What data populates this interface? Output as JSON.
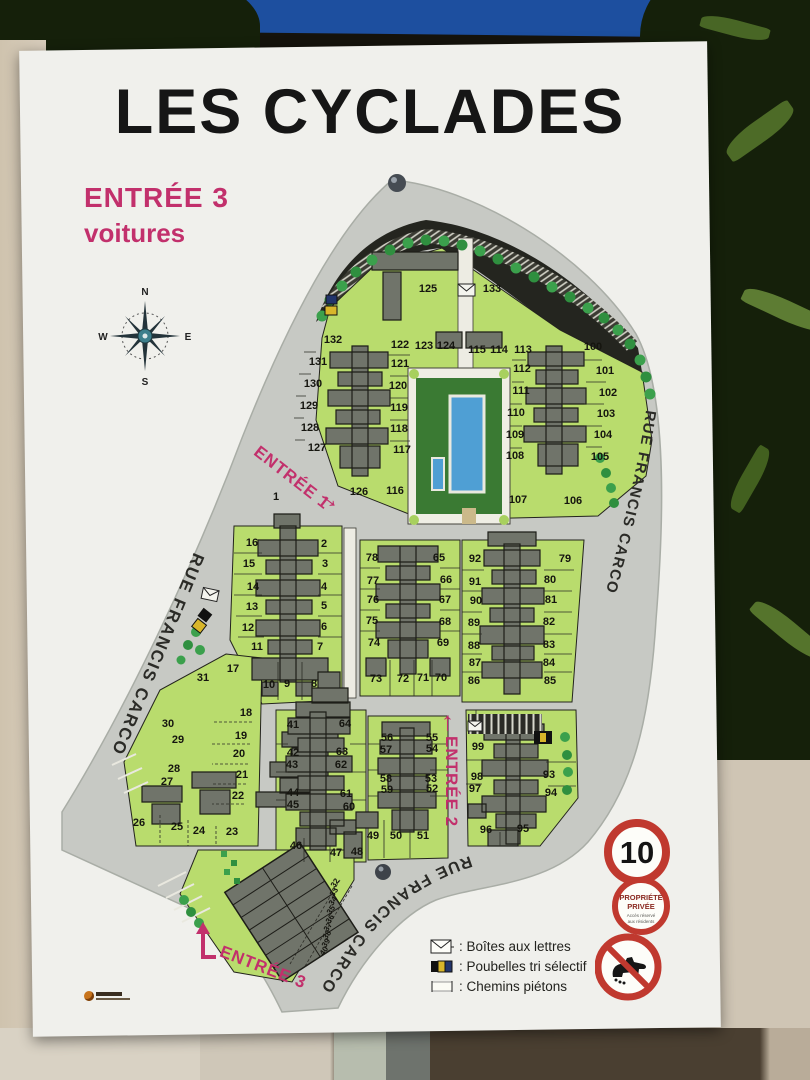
{
  "sign": {
    "title": "LES CYCLADES",
    "subtitle_line1": "ENTRÉE 3",
    "subtitle_line2": "voitures",
    "compass": {
      "n": "N",
      "e": "E",
      "s": "S",
      "w": "W"
    },
    "streets": {
      "left": "RUE FRANCIS CARCO",
      "right": "RUE FRANCIS CARCO",
      "bottom": "RUE FRANCIS CARCO"
    },
    "entrances": {
      "e1": {
        "label": "ENTRÉE 1",
        "arrow": "→"
      },
      "e2": {
        "label": "ENTRÉE 2",
        "arrow": "↑"
      },
      "e3": {
        "label": "ENTRÉE 3"
      }
    },
    "legend": {
      "items": [
        {
          "icon": "mailbox-icon",
          "label": ": Boîtes aux lettres"
        },
        {
          "icon": "recycle-bins-icon",
          "label": ": Poubelles tri sélectif"
        },
        {
          "icon": "footpath-icon",
          "label": ": Chemins piétons"
        }
      ]
    },
    "signs": {
      "speed_limit": "10",
      "private_line1": "PROPRIÉTÉ",
      "private_line2": "PRIVÉE",
      "private_sub1": "Accès réservé",
      "private_sub2": "aux résidents"
    },
    "colors": {
      "accent_pink": "#c2306c",
      "map_green": "#b9dc6d",
      "road_gray": "#c7c9c4",
      "building_gray": "#70746a",
      "pool_blue": "#4f9fd4",
      "sign_red": "#c0392f"
    },
    "plots": [
      {
        "n": "125",
        "x": 428,
        "y": 289
      },
      {
        "n": "133",
        "x": 492,
        "y": 289
      },
      {
        "n": "132",
        "x": 333,
        "y": 340
      },
      {
        "n": "131",
        "x": 318,
        "y": 362
      },
      {
        "n": "130",
        "x": 313,
        "y": 384
      },
      {
        "n": "129",
        "x": 309,
        "y": 406
      },
      {
        "n": "128",
        "x": 310,
        "y": 428
      },
      {
        "n": "127",
        "x": 317,
        "y": 448
      },
      {
        "n": "126",
        "x": 359,
        "y": 492
      },
      {
        "n": "116",
        "x": 395,
        "y": 491
      },
      {
        "n": "122",
        "x": 400,
        "y": 345
      },
      {
        "n": "121",
        "x": 400,
        "y": 364
      },
      {
        "n": "120",
        "x": 398,
        "y": 386
      },
      {
        "n": "119",
        "x": 399,
        "y": 408
      },
      {
        "n": "118",
        "x": 399,
        "y": 429
      },
      {
        "n": "117",
        "x": 402,
        "y": 450
      },
      {
        "n": "123",
        "x": 424,
        "y": 346
      },
      {
        "n": "124",
        "x": 446,
        "y": 346
      },
      {
        "n": "115",
        "x": 477,
        "y": 350
      },
      {
        "n": "114",
        "x": 499,
        "y": 350
      },
      {
        "n": "113",
        "x": 523,
        "y": 350
      },
      {
        "n": "112",
        "x": 522,
        "y": 369
      },
      {
        "n": "111",
        "x": 521,
        "y": 391
      },
      {
        "n": "110",
        "x": 516,
        "y": 413
      },
      {
        "n": "109",
        "x": 515,
        "y": 435
      },
      {
        "n": "108",
        "x": 515,
        "y": 456
      },
      {
        "n": "100",
        "x": 593,
        "y": 347
      },
      {
        "n": "101",
        "x": 605,
        "y": 371
      },
      {
        "n": "102",
        "x": 608,
        "y": 393
      },
      {
        "n": "103",
        "x": 606,
        "y": 414
      },
      {
        "n": "104",
        "x": 603,
        "y": 435
      },
      {
        "n": "105",
        "x": 600,
        "y": 457
      },
      {
        "n": "107",
        "x": 518,
        "y": 500
      },
      {
        "n": "106",
        "x": 573,
        "y": 501
      },
      {
        "n": "1",
        "x": 276,
        "y": 497
      },
      {
        "n": "16",
        "x": 252,
        "y": 543
      },
      {
        "n": "15",
        "x": 249,
        "y": 564
      },
      {
        "n": "14",
        "x": 253,
        "y": 587
      },
      {
        "n": "13",
        "x": 252,
        "y": 607
      },
      {
        "n": "12",
        "x": 248,
        "y": 628
      },
      {
        "n": "11",
        "x": 257,
        "y": 647
      },
      {
        "n": "2",
        "x": 324,
        "y": 544
      },
      {
        "n": "3",
        "x": 325,
        "y": 564
      },
      {
        "n": "4",
        "x": 324,
        "y": 587
      },
      {
        "n": "5",
        "x": 324,
        "y": 606
      },
      {
        "n": "6",
        "x": 324,
        "y": 627
      },
      {
        "n": "7",
        "x": 320,
        "y": 647
      },
      {
        "n": "10",
        "x": 269,
        "y": 685
      },
      {
        "n": "9",
        "x": 287,
        "y": 684
      },
      {
        "n": "8",
        "x": 314,
        "y": 684
      },
      {
        "n": "17",
        "x": 233,
        "y": 669
      },
      {
        "n": "78",
        "x": 372,
        "y": 558
      },
      {
        "n": "77",
        "x": 373,
        "y": 581
      },
      {
        "n": "76",
        "x": 373,
        "y": 600
      },
      {
        "n": "75",
        "x": 372,
        "y": 621
      },
      {
        "n": "74",
        "x": 374,
        "y": 643
      },
      {
        "n": "65",
        "x": 439,
        "y": 558
      },
      {
        "n": "66",
        "x": 446,
        "y": 580
      },
      {
        "n": "67",
        "x": 445,
        "y": 600
      },
      {
        "n": "68",
        "x": 445,
        "y": 622
      },
      {
        "n": "69",
        "x": 443,
        "y": 643
      },
      {
        "n": "73",
        "x": 376,
        "y": 679
      },
      {
        "n": "72",
        "x": 403,
        "y": 679
      },
      {
        "n": "71",
        "x": 423,
        "y": 678
      },
      {
        "n": "70",
        "x": 441,
        "y": 678
      },
      {
        "n": "92",
        "x": 475,
        "y": 559
      },
      {
        "n": "91",
        "x": 475,
        "y": 582
      },
      {
        "n": "90",
        "x": 476,
        "y": 601
      },
      {
        "n": "89",
        "x": 474,
        "y": 623
      },
      {
        "n": "88",
        "x": 474,
        "y": 646
      },
      {
        "n": "87",
        "x": 475,
        "y": 663
      },
      {
        "n": "86",
        "x": 474,
        "y": 681
      },
      {
        "n": "79",
        "x": 565,
        "y": 559
      },
      {
        "n": "80",
        "x": 550,
        "y": 580
      },
      {
        "n": "81",
        "x": 551,
        "y": 600
      },
      {
        "n": "82",
        "x": 549,
        "y": 622
      },
      {
        "n": "83",
        "x": 549,
        "y": 645
      },
      {
        "n": "84",
        "x": 549,
        "y": 663
      },
      {
        "n": "85",
        "x": 550,
        "y": 681
      },
      {
        "n": "31",
        "x": 203,
        "y": 678
      },
      {
        "n": "30",
        "x": 168,
        "y": 724
      },
      {
        "n": "29",
        "x": 178,
        "y": 740
      },
      {
        "n": "28",
        "x": 174,
        "y": 769
      },
      {
        "n": "27",
        "x": 167,
        "y": 782
      },
      {
        "n": "26",
        "x": 139,
        "y": 823
      },
      {
        "n": "25",
        "x": 177,
        "y": 827
      },
      {
        "n": "24",
        "x": 199,
        "y": 831
      },
      {
        "n": "23",
        "x": 232,
        "y": 832
      },
      {
        "n": "18",
        "x": 246,
        "y": 713
      },
      {
        "n": "19",
        "x": 241,
        "y": 736
      },
      {
        "n": "20",
        "x": 239,
        "y": 754
      },
      {
        "n": "21",
        "x": 242,
        "y": 775
      },
      {
        "n": "22",
        "x": 238,
        "y": 796
      },
      {
        "n": "41",
        "x": 293,
        "y": 725
      },
      {
        "n": "42",
        "x": 293,
        "y": 753
      },
      {
        "n": "43",
        "x": 292,
        "y": 765
      },
      {
        "n": "44",
        "x": 293,
        "y": 793
      },
      {
        "n": "45",
        "x": 293,
        "y": 805
      },
      {
        "n": "64",
        "x": 345,
        "y": 724
      },
      {
        "n": "63",
        "x": 342,
        "y": 752
      },
      {
        "n": "62",
        "x": 341,
        "y": 765
      },
      {
        "n": "61",
        "x": 346,
        "y": 794
      },
      {
        "n": "60",
        "x": 349,
        "y": 807
      },
      {
        "n": "46",
        "x": 296,
        "y": 846
      },
      {
        "n": "47",
        "x": 336,
        "y": 853
      },
      {
        "n": "48",
        "x": 357,
        "y": 852
      },
      {
        "n": "56",
        "x": 387,
        "y": 738
      },
      {
        "n": "57",
        "x": 386,
        "y": 750
      },
      {
        "n": "58",
        "x": 386,
        "y": 779
      },
      {
        "n": "59",
        "x": 387,
        "y": 790
      },
      {
        "n": "55",
        "x": 432,
        "y": 738
      },
      {
        "n": "54",
        "x": 432,
        "y": 749
      },
      {
        "n": "53",
        "x": 431,
        "y": 779
      },
      {
        "n": "52",
        "x": 432,
        "y": 789
      },
      {
        "n": "49",
        "x": 373,
        "y": 836
      },
      {
        "n": "50",
        "x": 396,
        "y": 836
      },
      {
        "n": "51",
        "x": 423,
        "y": 836
      },
      {
        "n": "99",
        "x": 478,
        "y": 747
      },
      {
        "n": "98",
        "x": 477,
        "y": 777
      },
      {
        "n": "97",
        "x": 475,
        "y": 789
      },
      {
        "n": "93",
        "x": 549,
        "y": 775
      },
      {
        "n": "94",
        "x": 551,
        "y": 793
      },
      {
        "n": "96",
        "x": 486,
        "y": 830
      },
      {
        "n": "95",
        "x": 523,
        "y": 829
      },
      {
        "n": "32",
        "x": 335,
        "y": 883,
        "r": -55,
        "s": 8
      },
      {
        "n": "33",
        "x": 334,
        "y": 892,
        "r": -55,
        "s": 8
      },
      {
        "n": "34",
        "x": 333,
        "y": 901,
        "r": -55,
        "s": 8
      },
      {
        "n": "35",
        "x": 331,
        "y": 910,
        "r": -55,
        "s": 8
      },
      {
        "n": "36",
        "x": 330,
        "y": 919,
        "r": -55,
        "s": 8
      },
      {
        "n": "37",
        "x": 328,
        "y": 927,
        "r": -55,
        "s": 8
      },
      {
        "n": "38",
        "x": 327,
        "y": 935,
        "r": -55,
        "s": 8
      },
      {
        "n": "39",
        "x": 326,
        "y": 943,
        "r": -55,
        "s": 8
      },
      {
        "n": "40",
        "x": 324,
        "y": 951,
        "r": -55,
        "s": 8
      }
    ]
  }
}
